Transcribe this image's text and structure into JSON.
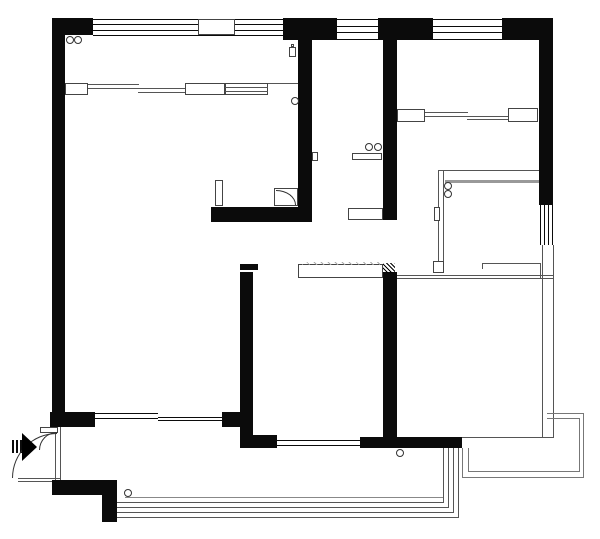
{
  "meta": {
    "type": "apartment-floor-plan",
    "canvas": {
      "width": 600,
      "height": 539
    },
    "palette": {
      "wall": "#0b0b0b",
      "line": "#555555",
      "outline": "#444444",
      "gray": "#999999",
      "background": "#ffffff"
    }
  },
  "elements": [
    {
      "t": "line",
      "name": "kitchen-wall-top-line",
      "x": 438,
      "y": 170,
      "w": 103,
      "h": 1
    },
    {
      "t": "line",
      "name": "kitchen-wall-top-thick-line",
      "x": 445,
      "y": 180,
      "w": 96,
      "h": 3,
      "c": "#999999"
    },
    {
      "t": "line",
      "name": "kitchen-wall-left-line",
      "x": 438,
      "y": 170,
      "w": 1,
      "h": 101
    },
    {
      "t": "line",
      "name": "kitchen-wall-left-line-2",
      "x": 443,
      "y": 170,
      "w": 1,
      "h": 101
    },
    {
      "t": "line",
      "name": "right-light-wall-line",
      "x": 542,
      "y": 245,
      "w": 1,
      "h": 193
    },
    {
      "t": "line",
      "name": "right-light-wall-line-2",
      "x": 553,
      "y": 245,
      "w": 1,
      "h": 193
    },
    {
      "t": "line",
      "name": "room2-top-partition-line",
      "x": 397,
      "y": 275,
      "w": 157,
      "h": 1
    },
    {
      "t": "line",
      "name": "room2-top-partition-line-2",
      "x": 397,
      "y": 278,
      "w": 157,
      "h": 1
    },
    {
      "t": "line",
      "name": "room2-bottom-partition-line",
      "x": 462,
      "y": 437,
      "w": 92,
      "h": 1
    },
    {
      "t": "line",
      "name": "cabinet-row-line",
      "x": 268,
      "y": 83,
      "w": 31,
      "h": 1
    },
    {
      "t": "line",
      "name": "sliding-door-track",
      "x": 88,
      "y": 84,
      "w": 51,
      "h": 1
    },
    {
      "t": "line",
      "name": "sliding-door-track",
      "x": 88,
      "y": 88,
      "w": 51,
      "h": 1
    },
    {
      "t": "line",
      "name": "sliding-door-track",
      "x": 138,
      "y": 88,
      "w": 48,
      "h": 1
    },
    {
      "t": "line",
      "name": "sliding-door-track",
      "x": 138,
      "y": 92,
      "w": 48,
      "h": 1
    },
    {
      "t": "line",
      "name": "sliding-door-track",
      "x": 425,
      "y": 112,
      "w": 43,
      "h": 1
    },
    {
      "t": "line",
      "name": "sliding-door-track",
      "x": 425,
      "y": 116,
      "w": 43,
      "h": 1
    },
    {
      "t": "line",
      "name": "sliding-door-track",
      "x": 467,
      "y": 116,
      "w": 42,
      "h": 1
    },
    {
      "t": "line",
      "name": "sliding-door-track",
      "x": 467,
      "y": 119,
      "w": 42,
      "h": 1
    },
    {
      "t": "line",
      "name": "balcony-inner-line",
      "x": 125,
      "y": 497,
      "w": 318,
      "h": 1,
      "c": "#888888"
    },
    {
      "t": "line",
      "name": "balcony-railing-line",
      "x": 117,
      "y": 502,
      "w": 327,
      "h": 1
    },
    {
      "t": "line",
      "name": "balcony-railing-line",
      "x": 112,
      "y": 507,
      "w": 337,
      "h": 1
    },
    {
      "t": "line",
      "name": "balcony-railing-line",
      "x": 108,
      "y": 512,
      "w": 346,
      "h": 1
    },
    {
      "t": "line",
      "name": "balcony-railing-line",
      "x": 104,
      "y": 517,
      "w": 355,
      "h": 1
    },
    {
      "t": "line",
      "name": "balcony-railing-line",
      "x": 443,
      "y": 448,
      "w": 1,
      "h": 55
    },
    {
      "t": "line",
      "name": "balcony-railing-line",
      "x": 448,
      "y": 448,
      "w": 1,
      "h": 60
    },
    {
      "t": "line",
      "name": "balcony-railing-line",
      "x": 453,
      "y": 448,
      "w": 1,
      "h": 65
    },
    {
      "t": "line",
      "name": "balcony-railing-line",
      "x": 458,
      "y": 448,
      "w": 1,
      "h": 70
    },
    {
      "t": "line",
      "name": "platform-edge-line",
      "x": 547,
      "y": 413,
      "w": 37,
      "h": 1,
      "c": "#777777"
    },
    {
      "t": "line",
      "name": "platform-edge-line",
      "x": 547,
      "y": 418,
      "w": 33,
      "h": 1,
      "c": "#777777"
    },
    {
      "t": "line",
      "name": "platform-edge-line",
      "x": 583,
      "y": 413,
      "w": 1,
      "h": 65,
      "c": "#777777"
    },
    {
      "t": "line",
      "name": "platform-edge-line",
      "x": 579,
      "y": 418,
      "w": 1,
      "h": 54,
      "c": "#777777"
    },
    {
      "t": "line",
      "name": "platform-edge-line",
      "x": 462,
      "y": 477,
      "w": 122,
      "h": 1,
      "c": "#777777"
    },
    {
      "t": "line",
      "name": "platform-edge-line",
      "x": 468,
      "y": 471,
      "w": 112,
      "h": 1,
      "c": "#777777"
    },
    {
      "t": "line",
      "name": "platform-edge-line",
      "x": 462,
      "y": 448,
      "w": 1,
      "h": 30,
      "c": "#777777"
    },
    {
      "t": "line",
      "name": "platform-edge-line",
      "x": 468,
      "y": 448,
      "w": 1,
      "h": 24,
      "c": "#777777"
    },
    {
      "t": "line",
      "name": "counter-outline-line",
      "x": 482,
      "y": 263,
      "w": 58,
      "h": 1
    },
    {
      "t": "line",
      "name": "counter-outline-line",
      "x": 482,
      "y": 278,
      "w": 72,
      "h": 1
    },
    {
      "t": "line",
      "name": "counter-outline-line",
      "x": 540,
      "y": 263,
      "w": 1,
      "h": 16
    },
    {
      "t": "line",
      "name": "counter-outline-line",
      "x": 482,
      "y": 263,
      "w": 1,
      "h": 6
    },
    {
      "t": "line",
      "name": "entry-threshold-line",
      "x": 18,
      "y": 478,
      "w": 42,
      "h": 1
    },
    {
      "t": "line",
      "name": "entry-threshold-line",
      "x": 18,
      "y": 481,
      "w": 42,
      "h": 1
    },
    {
      "t": "line",
      "name": "entry-door-frame-line",
      "x": 55,
      "y": 427,
      "w": 1,
      "h": 53
    },
    {
      "t": "line",
      "name": "entry-door-frame-line",
      "x": 60,
      "y": 427,
      "w": 1,
      "h": 53
    },
    {
      "t": "hwin",
      "name": "window-top-left",
      "x": 93,
      "y": 19,
      "w": 190,
      "h": 17,
      "n": 4
    },
    {
      "t": "hwin",
      "name": "window-top-middle",
      "x": 337,
      "y": 19,
      "w": 41,
      "h": 21,
      "n": 4
    },
    {
      "t": "hwin",
      "name": "window-top-right",
      "x": 433,
      "y": 19,
      "w": 69,
      "h": 21,
      "n": 4
    },
    {
      "t": "vwin",
      "name": "window-right-wall",
      "x": 540,
      "y": 205,
      "w": 13,
      "h": 40,
      "n": 4
    },
    {
      "t": "hwin",
      "name": "window-bottom-left",
      "x": 95,
      "y": 413,
      "w": 63,
      "h": 6,
      "n": 2
    },
    {
      "t": "hwin",
      "name": "window-bottom-left-2",
      "x": 158,
      "y": 417,
      "w": 64,
      "h": 4,
      "n": 2
    },
    {
      "t": "hwin",
      "name": "window-bottom-middle",
      "x": 275,
      "y": 440,
      "w": 85,
      "h": 6,
      "n": 2
    },
    {
      "t": "wall",
      "name": "exterior-wall-top-left-corner",
      "x": 52,
      "y": 18,
      "w": 41,
      "h": 17
    },
    {
      "t": "wall",
      "name": "exterior-wall-left",
      "x": 52,
      "y": 18,
      "w": 13,
      "h": 409
    },
    {
      "t": "wall",
      "name": "exterior-wall-top-segment",
      "x": 283,
      "y": 18,
      "w": 54,
      "h": 22
    },
    {
      "t": "wall",
      "name": "exterior-wall-top-segment",
      "x": 378,
      "y": 18,
      "w": 55,
      "h": 22
    },
    {
      "t": "wall",
      "name": "exterior-wall-top-right-corner",
      "x": 502,
      "y": 18,
      "w": 51,
      "h": 22
    },
    {
      "t": "wall",
      "name": "exterior-wall-right",
      "x": 539,
      "y": 18,
      "w": 14,
      "h": 187
    },
    {
      "t": "wall",
      "name": "interior-wall-living-hall",
      "x": 298,
      "y": 28,
      "w": 14,
      "h": 194
    },
    {
      "t": "wall",
      "name": "interior-wall-hall-bedroom",
      "x": 383,
      "y": 28,
      "w": 14,
      "h": 192
    },
    {
      "t": "wall",
      "name": "interior-wall-nook",
      "x": 211,
      "y": 207,
      "w": 99,
      "h": 15
    },
    {
      "t": "wall",
      "name": "interior-wall-cap",
      "x": 240,
      "y": 264,
      "w": 18,
      "h": 6
    },
    {
      "t": "wall",
      "name": "interior-wall-left-lower",
      "x": 240,
      "y": 272,
      "w": 13,
      "h": 176
    },
    {
      "t": "wall",
      "name": "window-pier",
      "x": 222,
      "y": 412,
      "w": 26,
      "h": 15
    },
    {
      "t": "wall",
      "name": "interior-wall-foot",
      "x": 253,
      "y": 435,
      "w": 24,
      "h": 13
    },
    {
      "t": "wall",
      "name": "interior-wall-right-lower",
      "x": 383,
      "y": 272,
      "w": 14,
      "h": 176
    },
    {
      "t": "wall",
      "name": "interior-wall-bottom-bar",
      "x": 360,
      "y": 437,
      "w": 102,
      "h": 11
    },
    {
      "t": "wall",
      "name": "exterior-wall-bottom-left",
      "x": 50,
      "y": 412,
      "w": 45,
      "h": 15
    },
    {
      "t": "wall",
      "name": "exterior-wall-bottom",
      "x": 52,
      "y": 480,
      "w": 65,
      "h": 15
    },
    {
      "t": "wall",
      "name": "exterior-wall-bottom-step",
      "x": 102,
      "y": 495,
      "w": 15,
      "h": 27
    },
    {
      "t": "wall",
      "name": "entry-marker-bar",
      "x": 12,
      "y": 440,
      "w": 2,
      "h": 13
    },
    {
      "t": "wall",
      "name": "entry-marker-bar",
      "x": 16,
      "y": 440,
      "w": 2,
      "h": 13
    },
    {
      "t": "wall",
      "name": "entry-marker-bar",
      "x": 20,
      "y": 440,
      "w": 2,
      "h": 13
    },
    {
      "t": "box",
      "name": "window-pier-box",
      "x": 198,
      "y": 19,
      "w": 37,
      "h": 16
    },
    {
      "t": "box",
      "name": "wardrobe-end-box",
      "x": 65,
      "y": 83,
      "w": 23,
      "h": 12
    },
    {
      "t": "box",
      "name": "wardrobe-end-box",
      "x": 185,
      "y": 83,
      "w": 40,
      "h": 12
    },
    {
      "t": "box",
      "name": "wardrobe-striped-box",
      "x": 225,
      "y": 83,
      "w": 43,
      "h": 12
    },
    {
      "t": "box",
      "name": "wardrobe-end-box",
      "x": 397,
      "y": 109,
      "w": 28,
      "h": 13
    },
    {
      "t": "box",
      "name": "wardrobe-end-box",
      "x": 508,
      "y": 108,
      "w": 30,
      "h": 14
    },
    {
      "t": "box",
      "name": "hall-shelf",
      "x": 352,
      "y": 153,
      "w": 30,
      "h": 7
    },
    {
      "t": "box",
      "name": "hall-shelf",
      "x": 348,
      "y": 208,
      "w": 35,
      "h": 12
    },
    {
      "t": "box",
      "name": "door-jamb-tab",
      "x": 312,
      "y": 152,
      "w": 6,
      "h": 9
    },
    {
      "t": "box",
      "name": "nook-pillar",
      "x": 215,
      "y": 180,
      "w": 8,
      "h": 26
    },
    {
      "t": "box",
      "name": "shower-unit-box",
      "x": 274,
      "y": 188,
      "w": 24,
      "h": 18
    },
    {
      "t": "box",
      "name": "beam-over-opening",
      "x": 298,
      "y": 264,
      "w": 85,
      "h": 14
    },
    {
      "t": "box",
      "name": "kitchen-wall-end-tab",
      "x": 433,
      "y": 261,
      "w": 11,
      "h": 12
    },
    {
      "t": "box",
      "name": "kitchen-wall-side-tab",
      "x": 434,
      "y": 207,
      "w": 6,
      "h": 14
    },
    {
      "t": "box",
      "name": "entry-door-cap",
      "x": 40,
      "y": 427,
      "w": 18,
      "h": 6
    },
    {
      "t": "box",
      "name": "fixture-bottle-body",
      "x": 289,
      "y": 47,
      "w": 7,
      "h": 10
    },
    {
      "t": "box",
      "name": "fixture-bottle-neck",
      "x": 291,
      "y": 44,
      "w": 3,
      "h": 3
    },
    {
      "t": "line",
      "name": "wardrobe-stripe-line",
      "x": 225,
      "y": 87,
      "w": 43,
      "h": 1
    },
    {
      "t": "line",
      "name": "wardrobe-stripe-line",
      "x": 225,
      "y": 91,
      "w": 43,
      "h": 1
    },
    {
      "t": "hatch",
      "name": "beam-hatch",
      "x": 383,
      "y": 263,
      "w": 12,
      "h": 10,
      "c": "#000000",
      "g": 3
    },
    {
      "t": "hatch",
      "name": "beam-hatch-light",
      "x": 302,
      "y": 262,
      "w": 78,
      "h": 3,
      "c": "#aaaaaa",
      "g": 5
    },
    {
      "t": "circle",
      "name": "fixture-circle",
      "x": 66,
      "y": 36,
      "w": 8,
      "h": 8
    },
    {
      "t": "circle",
      "name": "fixture-circle",
      "x": 74,
      "y": 36,
      "w": 8,
      "h": 8
    },
    {
      "t": "circle",
      "name": "fixture-circle",
      "x": 291,
      "y": 97,
      "w": 8,
      "h": 8
    },
    {
      "t": "circle",
      "name": "fixture-circle",
      "x": 365,
      "y": 143,
      "w": 8,
      "h": 8
    },
    {
      "t": "circle",
      "name": "fixture-circle",
      "x": 374,
      "y": 143,
      "w": 8,
      "h": 8
    },
    {
      "t": "circle",
      "name": "fixture-circle",
      "x": 444,
      "y": 182,
      "w": 8,
      "h": 8
    },
    {
      "t": "circle",
      "name": "fixture-circle",
      "x": 444,
      "y": 190,
      "w": 8,
      "h": 8
    },
    {
      "t": "circle",
      "name": "fixture-circle",
      "x": 124,
      "y": 489,
      "w": 8,
      "h": 8
    },
    {
      "t": "circle",
      "name": "fixture-circle",
      "x": 396,
      "y": 449,
      "w": 8,
      "h": 8
    },
    {
      "t": "arc",
      "name": "entry-door-swing-arc",
      "x": 12,
      "y": 433,
      "w": 45,
      "h": 45,
      "corner": "tl"
    },
    {
      "t": "arc",
      "name": "entry-door-small-arc",
      "x": 39,
      "y": 432,
      "w": 18,
      "h": 18,
      "corner": "tl"
    },
    {
      "t": "arc",
      "name": "shower-unit-curve",
      "x": 276,
      "y": 190,
      "w": 20,
      "h": 15,
      "corner": "tr"
    },
    {
      "t": "tri",
      "name": "entry-arrow",
      "x": 22,
      "y": 433,
      "s": 15
    }
  ]
}
